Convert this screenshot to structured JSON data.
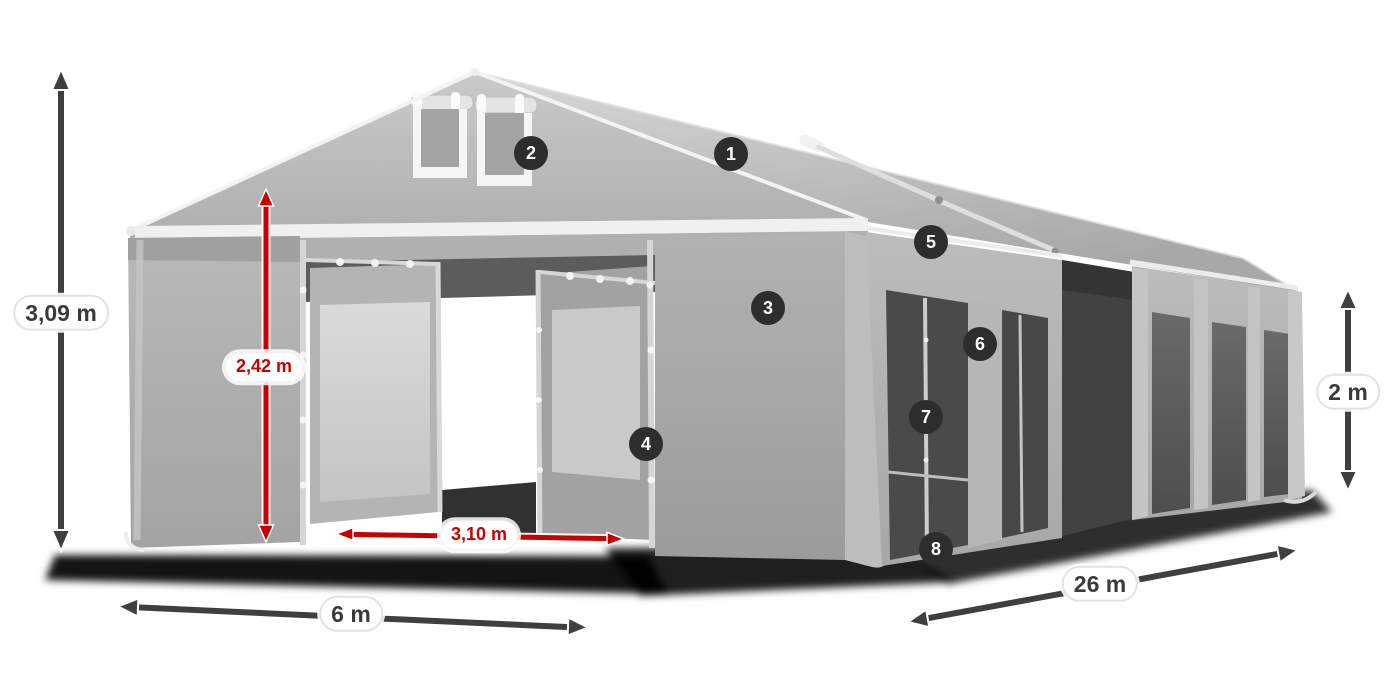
{
  "figure": {
    "subject": "party-tent-3d-render",
    "callout_count": 8
  },
  "callouts": [
    {
      "number": "1"
    },
    {
      "number": "2"
    },
    {
      "number": "3"
    },
    {
      "number": "4"
    },
    {
      "number": "5"
    },
    {
      "number": "6"
    },
    {
      "number": "7"
    },
    {
      "number": "8"
    }
  ],
  "dimensions": {
    "total_height": {
      "label": "3,09 m",
      "color": "gray"
    },
    "entrance_height": {
      "label": "2,42 m",
      "color": "red"
    },
    "entrance_width": {
      "label": "3,10 m",
      "color": "red"
    },
    "front_width": {
      "label": "6 m",
      "color": "gray"
    },
    "side_length": {
      "label": "26 m",
      "color": "gray"
    },
    "side_height": {
      "label": "2 m",
      "color": "gray"
    }
  },
  "colors": {
    "background": "#ffffff",
    "badge_background": "#2d2d2d",
    "badge_text": "#ffffff",
    "dimension_dark": "#3f3f3f",
    "dimension_red": "#c80000",
    "pill_background": "#ffffff",
    "tent_roof_light": "#d6d6d6",
    "tent_wall_mid": "#b0b0b0",
    "tent_wall_dark": "#9d9d9d",
    "mesh_dark": "#4a4a4a",
    "frame_white": "#f3f3f3",
    "ground_shadow": "#050505"
  }
}
